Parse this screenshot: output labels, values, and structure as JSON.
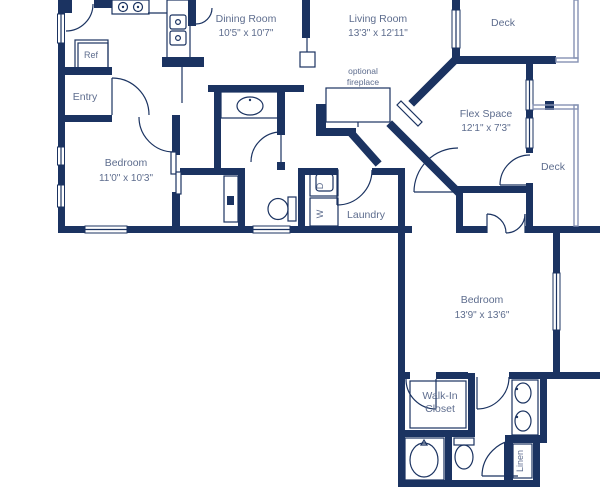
{
  "colors": {
    "wall": "#1b3361",
    "text": "#5e6d8e",
    "background": "#ffffff",
    "rail": "#8592b3"
  },
  "rooms": {
    "dining": {
      "name": "Dining Room",
      "dims": "10'5\" x 10'7\""
    },
    "living": {
      "name": "Living Room",
      "dims": "13'3\" x 12'11\""
    },
    "deck_top": {
      "name": "Deck"
    },
    "deck_right": {
      "name": "Deck"
    },
    "entry": {
      "name": "Entry"
    },
    "bedroom1": {
      "name": "Bedroom",
      "dims": "11'0\" x 10'3\""
    },
    "flex": {
      "name": "Flex Space",
      "dims": "12'1\" x 7'3\""
    },
    "laundry": {
      "name": "Laundry"
    },
    "bedroom2": {
      "name": "Bedroom",
      "dims": "13'9\" x 13'6\""
    },
    "walkin": {
      "line1": "Walk-In",
      "line2": "Closet"
    },
    "linen": {
      "name": "Linen"
    },
    "fireplace": {
      "line1": "optional",
      "line2": "fireplace"
    }
  },
  "appliances": {
    "ref": "Ref",
    "washer": "W",
    "dryer": "D"
  }
}
